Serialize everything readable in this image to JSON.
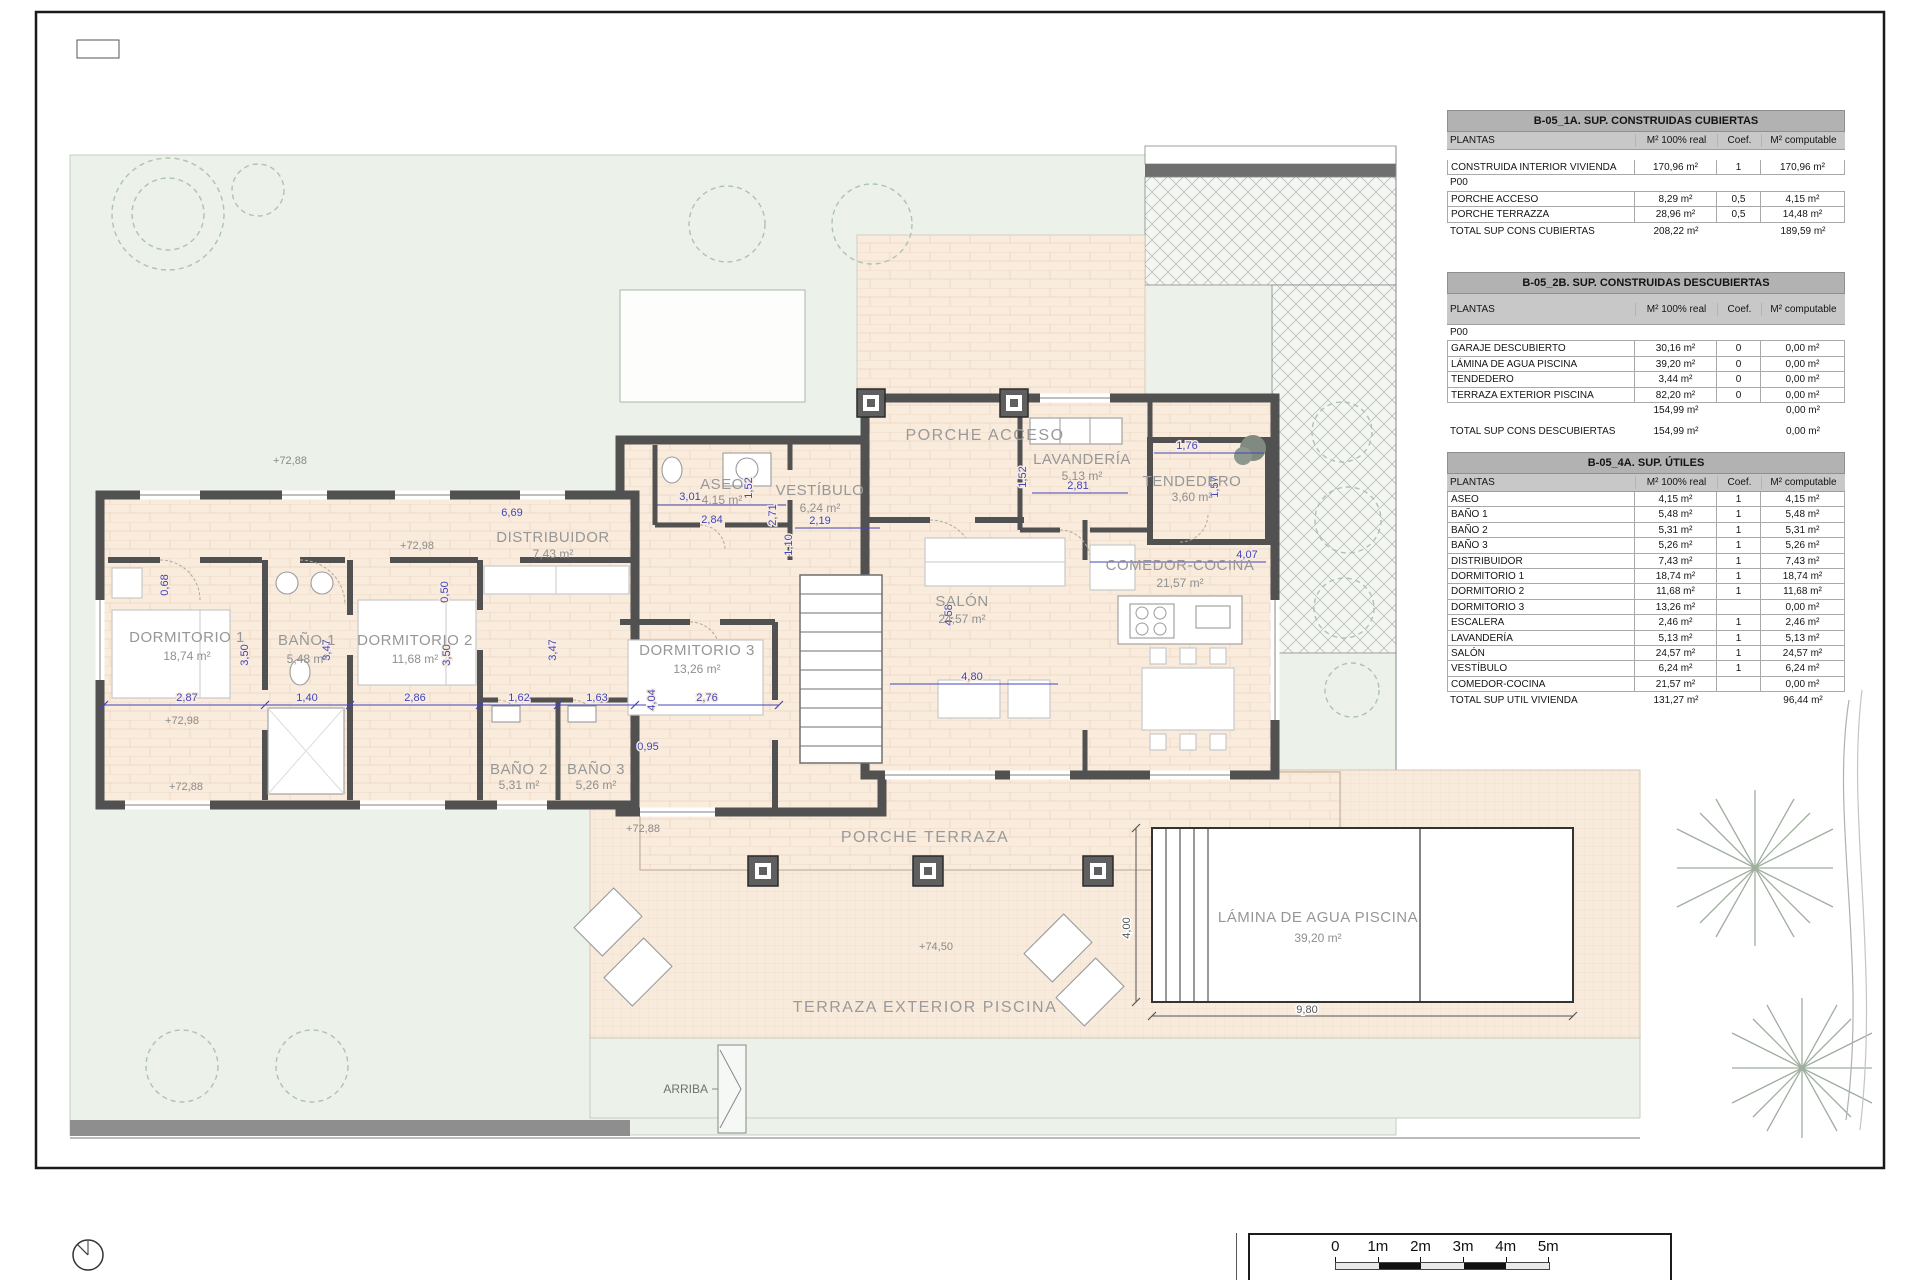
{
  "plan": {
    "rooms": {
      "dormitorio1": {
        "name": "DORMITORIO 1",
        "area": "18,74 m²"
      },
      "bano1": {
        "name": "BAÑO 1",
        "area": "5,48 m²"
      },
      "dormitorio2": {
        "name": "DORMITORIO 2",
        "area": "11,68 m²"
      },
      "bano2": {
        "name": "BAÑO 2",
        "area": "5,31 m²"
      },
      "bano3": {
        "name": "BAÑO 3",
        "area": "5,26 m²"
      },
      "dormitorio3": {
        "name": "DORMITORIO 3",
        "area": "13,26 m²"
      },
      "distribuidor": {
        "name": "DISTRIBUIDOR",
        "area": "7,43 m²"
      },
      "aseo": {
        "name": "ASEO",
        "area": "4,15 m²"
      },
      "vestibulo": {
        "name": "VESTÍBULO",
        "area": "6,24 m²"
      },
      "porche_acceso": {
        "name": "PORCHE ACCESO"
      },
      "lavanderia": {
        "name": "LAVANDERÍA",
        "area": "5,13 m²"
      },
      "tendedero": {
        "name": "TENDEDERO",
        "area": "3,60 m²"
      },
      "comedor": {
        "name": "COMEDOR-COCINA",
        "area": "21,57 m²"
      },
      "salon": {
        "name": "SALÓN",
        "area": "24,57 m²"
      },
      "porche_terraza": {
        "name": "PORCHE TERRAZA"
      },
      "terraza_exterior": {
        "name": "TERRAZA EXTERIOR PISCINA"
      },
      "piscina": {
        "name": "LÁMINA DE AGUA PISCINA",
        "area": "39,20 m²"
      },
      "arriba": {
        "name": "ARRIBA"
      }
    },
    "levels": [
      "+72,88",
      "+72,98",
      "+72,98",
      "+72,88",
      "+72,88",
      "+74,50"
    ],
    "dims": [
      "2,87",
      "1,40",
      "2,86",
      "1,62",
      "1,63",
      "2,76",
      "0,95",
      "3,50",
      "3,47",
      "3,50",
      "3,47",
      "4,04",
      "0,68",
      "0,50",
      "6,69",
      "1,10",
      "3,01",
      "1,52",
      "2,71",
      "2,19",
      "2,84",
      "1,52",
      "2,81",
      "1,76",
      "1,57",
      "4,80",
      "4,58",
      "4,07",
      "4,00",
      "9,80"
    ]
  },
  "tables": [
    {
      "title": "B-05_1A. SUP. CONSTRUIDAS CUBIERTAS",
      "columns": [
        "PLANTAS",
        "M² 100% real",
        "Coef.",
        "M² computable"
      ],
      "rows": [
        {
          "label": "CONSTRUIDA INTERIOR VIVIENDA",
          "real": "170,96 m²",
          "coef": "1",
          "comp": "170,96 m²"
        },
        {
          "label": "P00",
          "cls": "section"
        },
        {
          "label": "PORCHE ACCESO",
          "real": "8,29 m²",
          "coef": "0,5",
          "comp": "4,15 m²"
        },
        {
          "label": "PORCHE TERRAZZA",
          "real": "28,96 m²",
          "coef": "0,5",
          "comp": "14,48 m²"
        }
      ],
      "total": {
        "label": "TOTAL SUP CONS CUBIERTAS",
        "real": "208,22 m²",
        "comp": "189,59 m²"
      }
    },
    {
      "title": "B-05_2B. SUP. CONSTRUIDAS DESCUBIERTAS",
      "columns": [
        "PLANTAS",
        "M² 100% real",
        "Coef.",
        "M² computable"
      ],
      "rows": [
        {
          "label": "P00",
          "cls": "section"
        },
        {
          "label": "GARAJE DESCUBIERTO",
          "real": "30,16 m²",
          "coef": "0",
          "comp": "0,00 m²"
        },
        {
          "label": "LÁMINA DE AGUA PISCINA",
          "real": "39,20 m²",
          "coef": "0",
          "comp": "0,00 m²"
        },
        {
          "label": "TENDEDERO",
          "real": "3,44 m²",
          "coef": "0",
          "comp": "0,00 m²"
        },
        {
          "label": "TERRAZA EXTERIOR PISCINA",
          "real": "82,20 m²",
          "coef": "0",
          "comp": "0,00 m²"
        },
        {
          "label": "",
          "real": "154,99 m²",
          "comp": "0,00 m²",
          "cls": "plain"
        }
      ],
      "total": {
        "label": "TOTAL SUP CONS DESCUBIERTAS",
        "real": "154,99 m²",
        "comp": "0,00 m²"
      }
    },
    {
      "title": "B-05_4A. SUP. ÚTILES",
      "columns": [
        "PLANTAS",
        "M² 100% real",
        "Coef.",
        "M² computable"
      ],
      "rows": [
        {
          "label": "ASEO",
          "real": "4,15 m²",
          "coef": "1",
          "comp": "4,15 m²"
        },
        {
          "label": "BAÑO 1",
          "real": "5,48 m²",
          "coef": "1",
          "comp": "5,48 m²"
        },
        {
          "label": "BAÑO 2",
          "real": "5,31 m²",
          "coef": "1",
          "comp": "5,31 m²"
        },
        {
          "label": "BAÑO 3",
          "real": "5,26 m²",
          "coef": "1",
          "comp": "5,26 m²"
        },
        {
          "label": "DISTRIBUIDOR",
          "real": "7,43 m²",
          "coef": "1",
          "comp": "7,43 m²"
        },
        {
          "label": "DORMITORIO 1",
          "real": "18,74 m²",
          "coef": "1",
          "comp": "18,74 m²"
        },
        {
          "label": "DORMITORIO 2",
          "real": "11,68 m²",
          "coef": "1",
          "comp": "11,68 m²"
        },
        {
          "label": "DORMITORIO 3",
          "real": "13,26 m²",
          "coef": "",
          "comp": "0,00 m²"
        },
        {
          "label": "ESCALERA",
          "real": "2,46 m²",
          "coef": "1",
          "comp": "2,46 m²"
        },
        {
          "label": "LAVANDERÍA",
          "real": "5,13 m²",
          "coef": "1",
          "comp": "5,13 m²"
        },
        {
          "label": "SALÓN",
          "real": "24,57 m²",
          "coef": "1",
          "comp": "24,57 m²"
        },
        {
          "label": "VESTÍBULO",
          "real": "6,24 m²",
          "coef": "1",
          "comp": "6,24 m²"
        },
        {
          "label": "COMEDOR-COCINA",
          "real": "21,57 m²",
          "coef": "",
          "comp": "0,00 m²"
        }
      ],
      "total": {
        "label": "TOTAL SUP UTIL VIVIENDA",
        "real": "131,27 m²",
        "comp": "96,44 m²"
      }
    }
  ],
  "scalebar": {
    "labels": [
      "0",
      "1m",
      "2m",
      "3m",
      "4m",
      "5m"
    ]
  }
}
